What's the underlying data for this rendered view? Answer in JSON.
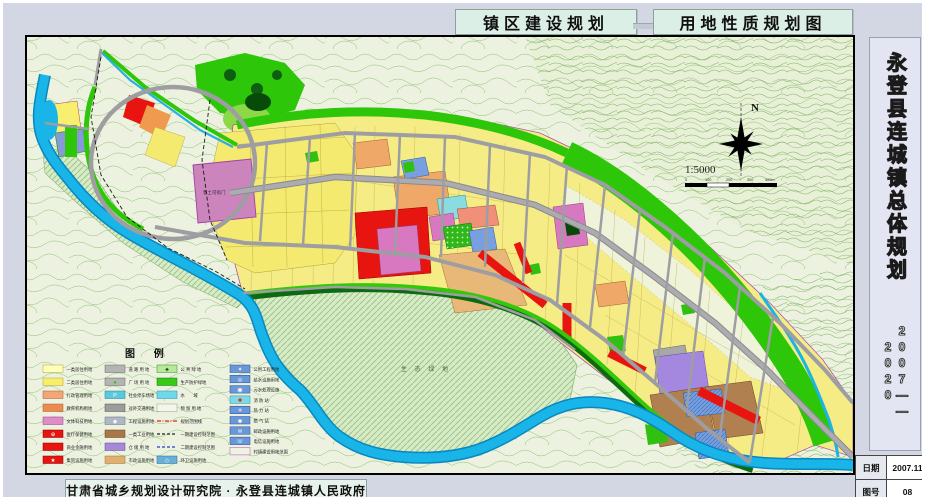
{
  "titles": {
    "left_box": "镇区建设规划",
    "right_box": "用地性质规划图"
  },
  "sidebar": {
    "title_vertical": "永登县连城镇总体规划",
    "years_vertical": "2007——2020",
    "date_label": "日期",
    "date_value": "2007.11",
    "sheet_label": "图号",
    "sheet_value": "08"
  },
  "footer": {
    "credit": "甘肃省城乡规划设计研究院 · 永登县连城镇人民政府"
  },
  "map": {
    "north_label": "N",
    "scale_text": "1:5000",
    "scale_ticks": [
      "0",
      "100",
      "200",
      "300",
      "400m"
    ],
    "labels": {
      "historic_site": "鲁土司衙门",
      "eco_green": "生 态 绿 地"
    }
  },
  "legend": {
    "title": "图  例",
    "columns": [
      [
        {
          "label": "一类居住用地",
          "fill": "#ffffb8",
          "border": "#b0a040"
        },
        {
          "label": "二类居住用地",
          "fill": "#f7ee6a",
          "border": "#b0a040"
        },
        {
          "label": "行政管理用地",
          "fill": "#f4a678",
          "border": "#a06030"
        },
        {
          "label": "教育机构用地",
          "fill": "#ee8a50",
          "border": "#a06030"
        },
        {
          "label": "文体科技用地",
          "fill": "#e08cc8",
          "border": "#904080"
        },
        {
          "label": "医疗保健用地",
          "fill": "#e81410",
          "border": "#800000",
          "sym": "⊕",
          "symColor": "#ffffff"
        },
        {
          "label": "商业金融用地",
          "fill": "#e81410",
          "border": "#800000"
        },
        {
          "label": "集贸设施用地",
          "fill": "#e81410",
          "border": "#800000",
          "sym": "★",
          "symColor": "#ffffff"
        }
      ],
      [
        {
          "label": "道 路 用 地",
          "fill": "#b4b4b4",
          "border": "#666666"
        },
        {
          "label": "广 场 用 地",
          "fill": "#b4b4b4",
          "border": "#666666",
          "sym": "●",
          "symColor": "#30c010"
        },
        {
          "label": "社会停车场地",
          "fill": "#5cc8e0",
          "border": "#2080a0",
          "sym": "P",
          "symColor": "#ffffff"
        },
        {
          "label": "对外交通用地",
          "fill": "#9c9c9c",
          "border": "#555555"
        },
        {
          "label": "工程设施用地",
          "fill": "#b0b8c8",
          "border": "#607080",
          "sym": "◆",
          "symColor": "#ffffff"
        },
        {
          "label": "一类工业用地",
          "fill": "#a87848",
          "border": "#6a4020"
        },
        {
          "label": "仓 储 用 地",
          "fill": "#a888d8",
          "border": "#6048a0"
        },
        {
          "label": "市政设施用地",
          "fill": "#e0b070",
          "border": "#a07030"
        }
      ],
      [
        {
          "label": "公 共 绿 地",
          "fill": "#b8e89c",
          "border": "#3a8a2a",
          "sym": "♣",
          "symColor": "#0a5a0a"
        },
        {
          "label": "生产防护绿地",
          "fill": "#38c818",
          "border": "#107a08"
        },
        {
          "label": "水　　域",
          "fill": "#70d8e8",
          "border": "#2090b8"
        },
        {
          "label": "预 留 用 地",
          "fill": "#f4f8ec",
          "border": "#90a080"
        },
        {
          "label": "规划范围线",
          "line": "dashdot",
          "color": "#e02020"
        },
        {
          "label": "一期建设控制范围",
          "line": "dash",
          "color": "#202020"
        },
        {
          "label": "二期建设控制范围",
          "line": "dash",
          "color": "#2040d0"
        },
        {
          "label": "环卫设施用地",
          "fill": "#68b0d8",
          "border": "#2a6898",
          "sym": "◇",
          "symColor": "#ffffff"
        }
      ],
      [
        {
          "label": "公用工程用地",
          "fill": "#6898d8",
          "border": "#2a4a98",
          "sym": "✦",
          "symColor": "#ffffff"
        },
        {
          "label": "给水设施用地",
          "fill": "#6898d8",
          "border": "#2a4a98",
          "sym": "◎",
          "symColor": "#ffffff"
        },
        {
          "label": "污水处理设施",
          "fill": "#6898d8",
          "border": "#2a4a98",
          "sym": "▣",
          "symColor": "#ffffff"
        },
        {
          "label": "消 防 站",
          "fill": "#80d8e0",
          "border": "#2090a8",
          "sym": "✚",
          "symColor": "#e01010"
        },
        {
          "label": "热 力 站",
          "fill": "#6898d8",
          "border": "#2a4a98",
          "sym": "✳",
          "symColor": "#ffffff"
        },
        {
          "label": "燃 气 站",
          "fill": "#6898d8",
          "border": "#2a4a98",
          "sym": "◉",
          "symColor": "#ffffff"
        },
        {
          "label": "邮政设施用地",
          "fill": "#6898d8",
          "border": "#2a4a98",
          "sym": "✉",
          "symColor": "#ffffff"
        },
        {
          "label": "电信设施用地",
          "fill": "#6898d8",
          "border": "#2a4a98",
          "sym": "☏",
          "symColor": "#ffffff"
        },
        {
          "label": "村镇建设用地范围",
          "fill": "#f2f2e4",
          "border": "#b050b0"
        }
      ]
    ]
  },
  "colors": {
    "page_bg": "#d3d7e3",
    "topo_bg": "#ecf2df",
    "contour": "#8cbf72",
    "water": "#19b4e8",
    "green_belt": "#2ec608",
    "dark_green": "#0c6a10",
    "residential_yellow": "#f5ec86",
    "commercial_red": "#e81410",
    "historic_mauve": "#cc84bc",
    "culture_pink": "#d878c0",
    "admin_orange": "#f0a868",
    "industry_brown": "#b08050",
    "storage_purple": "#a488e0",
    "utility_blue": "#78a0e0",
    "road_gray": "#9e9ea2",
    "eco_hatch_bg": "#d8ebc7"
  }
}
